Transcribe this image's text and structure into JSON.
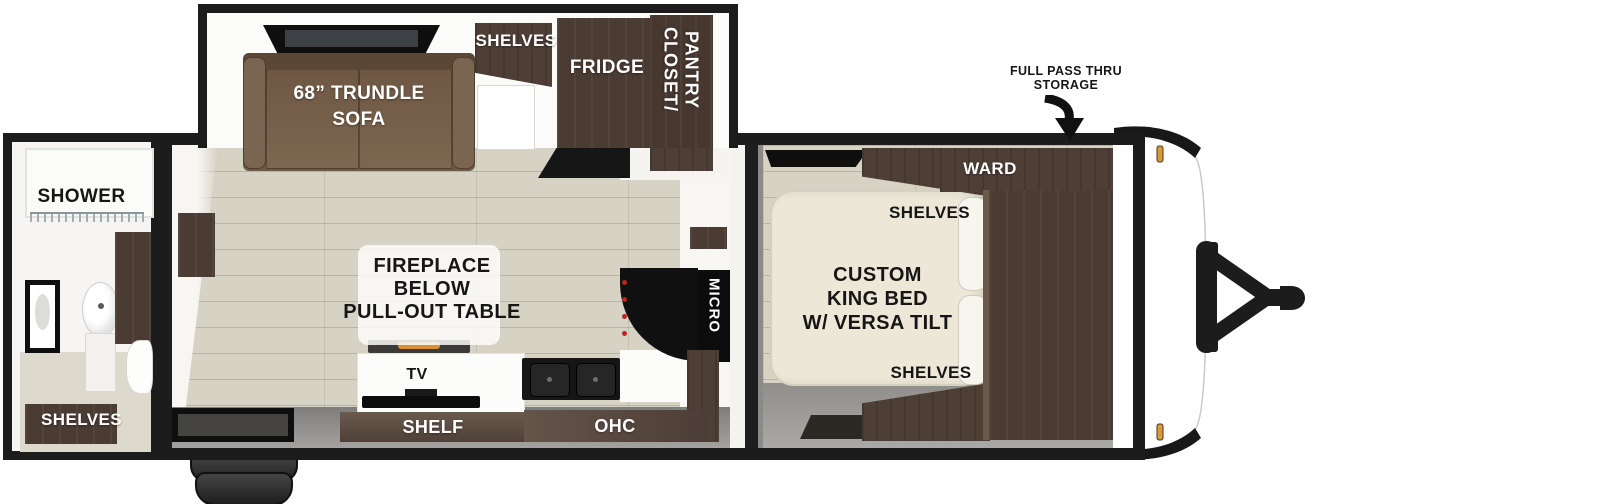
{
  "rear_bath": {
    "shower": "SHOWER",
    "shelves": "SHELVES"
  },
  "slide_out": {
    "sofa_line1": "68” TRUNDLE",
    "sofa_line2": "SOFA",
    "shelves": "SHELVES",
    "fridge": "FRIDGE",
    "closet_line1": "CLOSET/",
    "closet_line2": "PANTRY"
  },
  "living": {
    "fireplace_line1": "FIREPLACE",
    "fireplace_line2": "BELOW",
    "fireplace_line3": "PULL-OUT TABLE",
    "tv": "TV",
    "shelf": "SHELF",
    "ohc": "OHC",
    "micro": "MICRO"
  },
  "bedroom": {
    "bed_line1": "CUSTOM",
    "bed_line2": "KING BED",
    "bed_line3": "W/ VERSA TILT",
    "shelves_top": "SHELVES",
    "shelves_bottom": "SHELVES",
    "ward": "WARD"
  },
  "front": {
    "storage_line1": "FULL PASS THRU",
    "storage_line2": "STORAGE"
  },
  "colors": {
    "wall_black": "#1c1c1c",
    "dark_wood": "#4a3b33",
    "sofa_brown": "#6f5945",
    "floor_beige": "#d6d2c4",
    "bed_cream": "#ece7d6",
    "amber_light": "#d79a38",
    "flame_orange": "#d98f36",
    "knob_red": "#c0241c"
  }
}
